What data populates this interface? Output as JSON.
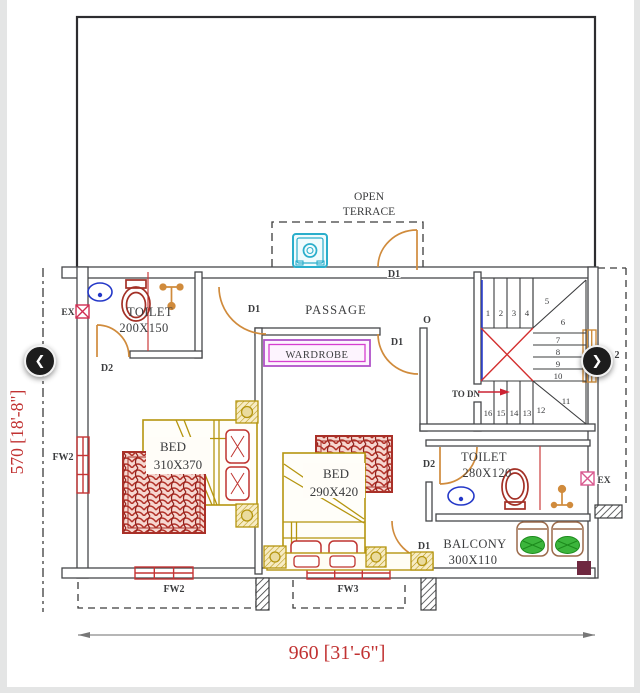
{
  "plan": {
    "terrace": {
      "line1": "OPEN",
      "line2": "TERRACE"
    },
    "passage_label": "PASSAGE",
    "wardrobe_label": "WARDROBE",
    "opening_label": "O",
    "toilet1": {
      "name": "TOILET",
      "size": "200X150"
    },
    "toilet2": {
      "name": "TOILET",
      "size": "280X120"
    },
    "bed1": {
      "name": "BED",
      "size": "310X370"
    },
    "bed2": {
      "name": "BED",
      "size": "290X420"
    },
    "balcony": {
      "name": "BALCONY",
      "size": "300X110"
    },
    "doors": {
      "d1": "D1",
      "d2": "D2"
    },
    "windows": {
      "fw2": "FW2",
      "fw3": "FW3",
      "stair_window_partial": "2"
    },
    "exhaust_label": "EX",
    "stairs": {
      "to_dn": "TO DN",
      "treads": [
        "1",
        "2",
        "3",
        "4",
        "5",
        "6",
        "7",
        "8",
        "9",
        "10",
        "11",
        "12",
        "13",
        "14",
        "15",
        "16"
      ]
    },
    "dimensions": {
      "width": "960 [31'-6\"]",
      "height": "570 [18'-8\"]"
    },
    "colors": {
      "wall": "#46474a",
      "door": "#d08b3c",
      "window_red": "#c43434",
      "bed_gold": "#b5950f",
      "rug_red": "#a93028",
      "wardrobe_magenta": "#b052c8",
      "washer_cyan": "#2aaecb",
      "fixture_blue": "#2438c8",
      "wc_maroon": "#a33026",
      "stair_x_red": "#d32f2f",
      "stair_rail_blue": "#2b3fd0",
      "dim_red": "#c13232",
      "corner_maroon": "#6f2840",
      "plant_green": "#3cb53c"
    }
  },
  "nav": {
    "prev_glyph": "❮",
    "next_glyph": "❯"
  }
}
